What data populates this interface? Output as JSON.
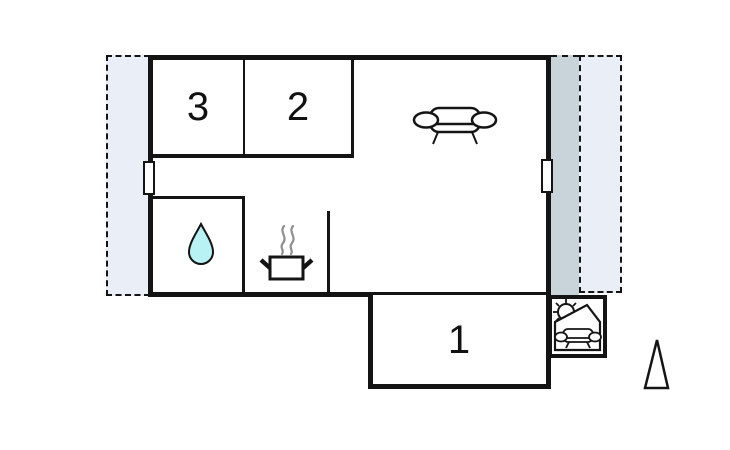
{
  "title": "holiday-home-floor-plan",
  "rooms": [
    {
      "label": "3"
    },
    {
      "label": "2"
    },
    {
      "label": "1"
    }
  ],
  "icons": {
    "sofa": "sofa-icon",
    "water_drop": "water-drop-icon",
    "cooking": "cooking-pot-icon",
    "covered_seating": "covered-seating-icon",
    "north_arrow": "north-arrow-icon",
    "window": "window-marker"
  },
  "colors": {
    "wall": "#141414",
    "terrace": "#eaeff7",
    "terrace_shaded": "#c9d4da",
    "water": "#b9f2f4",
    "steam": "#8f8f8f"
  }
}
